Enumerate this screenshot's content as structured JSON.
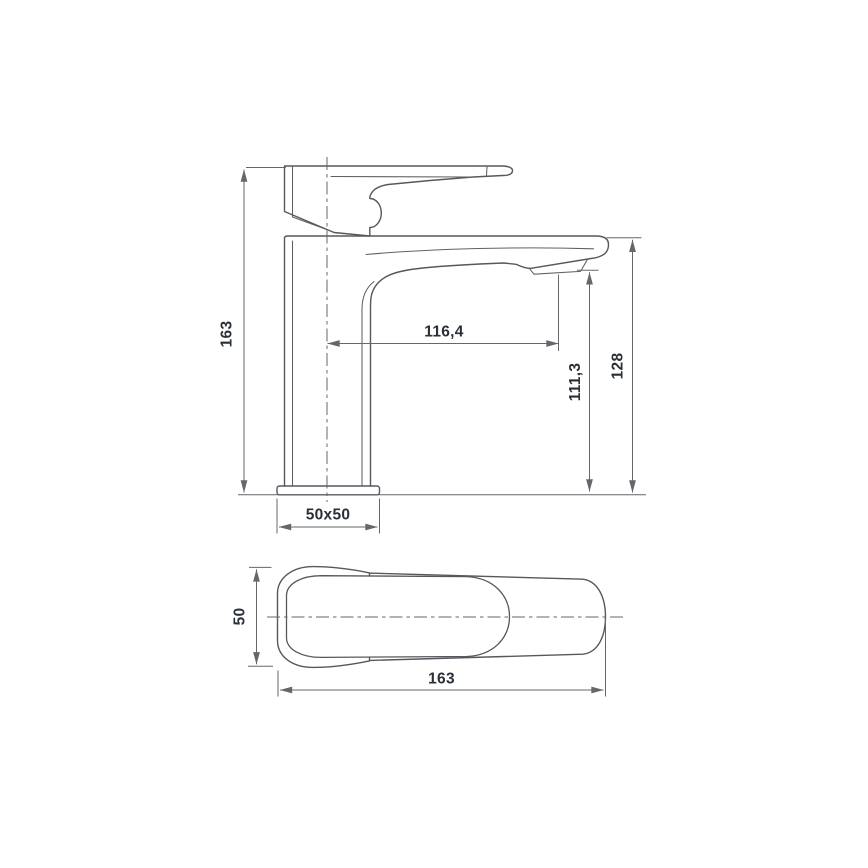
{
  "diagram": {
    "kind": "technical-dimension-drawing",
    "subject": "single-lever washbasin faucet, front elevation and top view",
    "front_view": {
      "dimensions": {
        "total_height": "163",
        "spout_reach": "116,4",
        "spout_outlet_height": "111,3",
        "body_top_height": "128",
        "base_footprint": "50x50"
      }
    },
    "top_view": {
      "dimensions": {
        "body_width": "50",
        "total_length": "163"
      }
    },
    "style": {
      "background": "#ffffff",
      "outline_color": "#55585c",
      "dimension_color": "#64676b",
      "text_color": "#2a3038"
    }
  }
}
